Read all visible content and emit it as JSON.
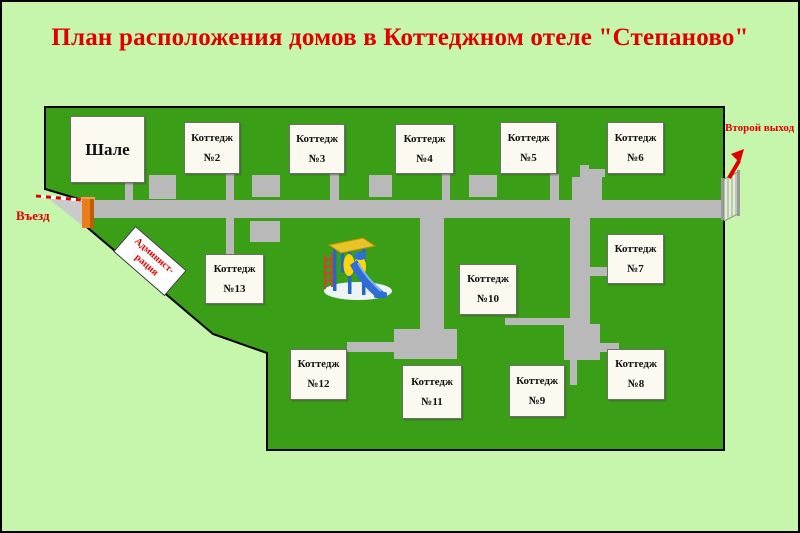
{
  "title": "План расположения домов в Коттеджном отеле \"Степаново\"",
  "map": {
    "entrance_label": "Въезд",
    "second_exit_label": "Второй выход",
    "administration": {
      "line1": "Админист-",
      "line2": "рация"
    },
    "buildings": [
      {
        "id": "chalet",
        "label": "Шале",
        "x": 68,
        "y": 114,
        "w": 75,
        "h": 67
      },
      {
        "id": "cottage-2",
        "line1": "Коттедж",
        "line2": "№2",
        "x": 182,
        "y": 120,
        "w": 56,
        "h": 52
      },
      {
        "id": "cottage-3",
        "line1": "Коттедж",
        "line2": "№3",
        "x": 287,
        "y": 122,
        "w": 56,
        "h": 50
      },
      {
        "id": "cottage-4",
        "line1": "Коттедж",
        "line2": "№4",
        "x": 393,
        "y": 122,
        "w": 59,
        "h": 50
      },
      {
        "id": "cottage-5",
        "line1": "Коттедж",
        "line2": "№5",
        "x": 498,
        "y": 120,
        "w": 57,
        "h": 52
      },
      {
        "id": "cottage-6",
        "line1": "Коттедж",
        "line2": "№6",
        "x": 605,
        "y": 120,
        "w": 57,
        "h": 52
      },
      {
        "id": "cottage-7",
        "line1": "Коттедж",
        "line2": "№7",
        "x": 605,
        "y": 232,
        "w": 57,
        "h": 50
      },
      {
        "id": "cottage-8",
        "line1": "Коттедж",
        "line2": "№8",
        "x": 605,
        "y": 347,
        "w": 58,
        "h": 51
      },
      {
        "id": "cottage-9",
        "line1": "Коттедж",
        "line2": "№9",
        "x": 507,
        "y": 363,
        "w": 56,
        "h": 52
      },
      {
        "id": "cottage-10",
        "line1": "Коттедж",
        "line2": "№10",
        "x": 457,
        "y": 262,
        "w": 58,
        "h": 51
      },
      {
        "id": "cottage-11",
        "line1": "Коттедж",
        "line2": "№11",
        "x": 400,
        "y": 363,
        "w": 60,
        "h": 54
      },
      {
        "id": "cottage-12",
        "line1": "Коттедж",
        "line2": "№12",
        "x": 288,
        "y": 347,
        "w": 57,
        "h": 51
      },
      {
        "id": "cottage-13",
        "line1": "Коттедж",
        "line2": "№13",
        "x": 203,
        "y": 252,
        "w": 59,
        "h": 50
      }
    ]
  },
  "colors": {
    "background": "#c6f5ac",
    "field": "#3b9e17",
    "road": "#b9b9b9",
    "building_fill": "#fcf9f0",
    "accent_red": "#e10000"
  }
}
